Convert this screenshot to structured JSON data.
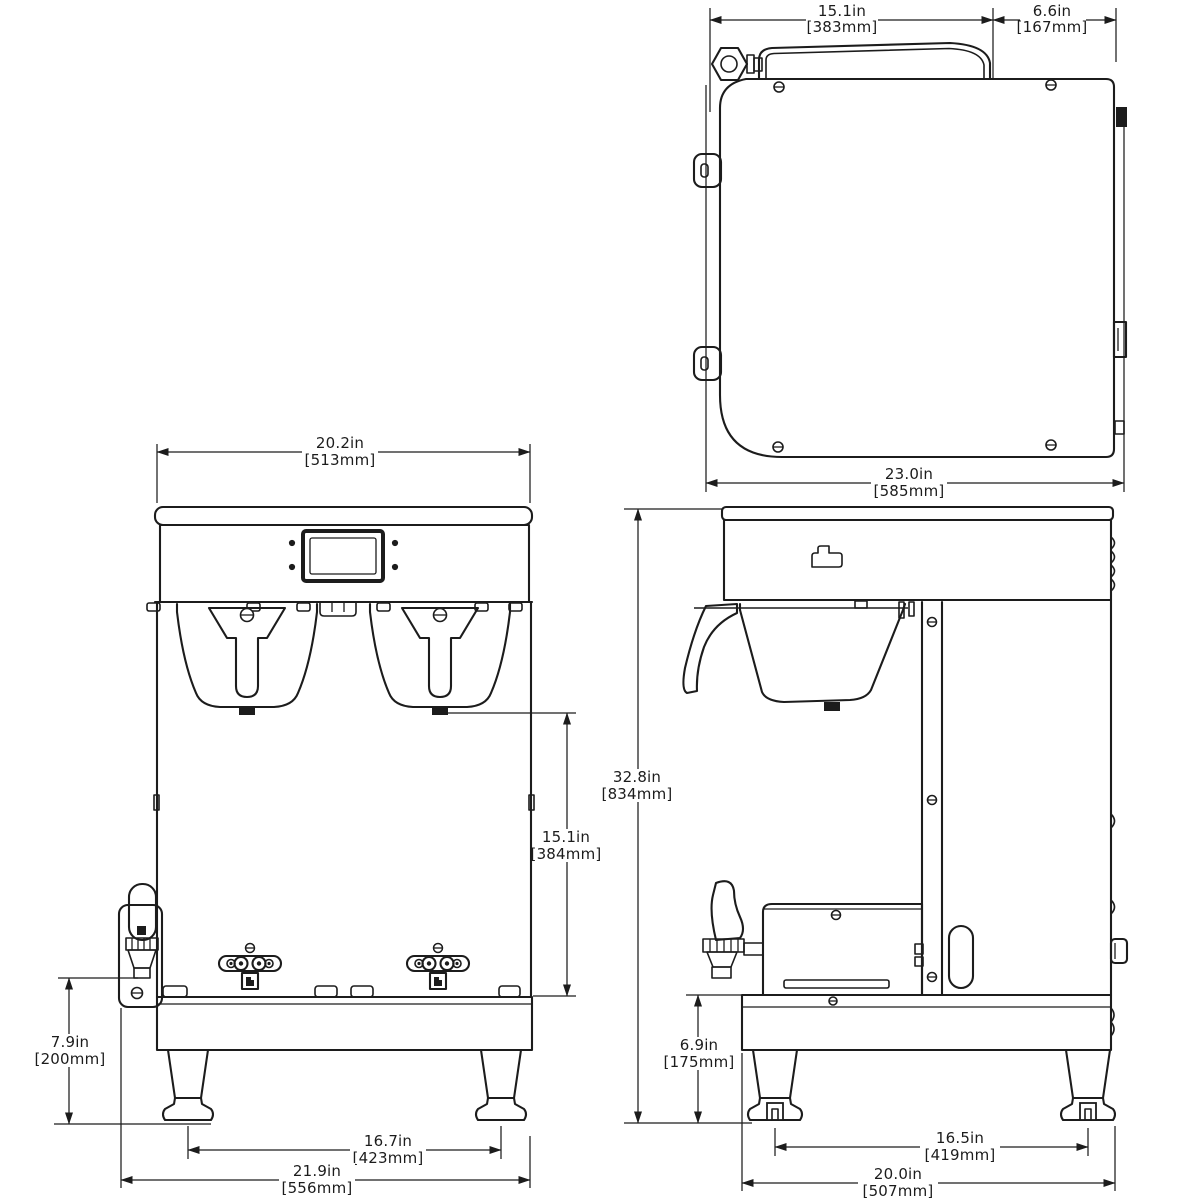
{
  "drawing_type": "dimensioned technical line drawing, three orthographic views of a dual coffee brewer",
  "colors": {
    "line": "#1c1c1c",
    "background": "#ffffff"
  },
  "dims": {
    "top_width": {
      "in": "15.1in",
      "mm": "[383mm]"
    },
    "top_rear_offset": {
      "in": "6.6in",
      "mm": "[167mm]"
    },
    "top_depth": {
      "in": "23.0in",
      "mm": "[585mm]"
    },
    "front_body_width": {
      "in": "20.2in",
      "mm": "[513mm]"
    },
    "front_clearance": {
      "in": "15.1in",
      "mm": "[384mm]"
    },
    "front_base_height": {
      "in": "7.9in",
      "mm": "[200mm]"
    },
    "front_feet_span": {
      "in": "16.7in",
      "mm": "[423mm]"
    },
    "front_overall_width": {
      "in": "21.9in",
      "mm": "[556mm]"
    },
    "side_overall_height": {
      "in": "32.8in",
      "mm": "[834mm]"
    },
    "side_base_height": {
      "in": "6.9in",
      "mm": "[175mm]"
    },
    "side_feet_span": {
      "in": "16.5in",
      "mm": "[419mm]"
    },
    "side_overall_depth": {
      "in": "20.0in",
      "mm": "[507mm]"
    }
  }
}
